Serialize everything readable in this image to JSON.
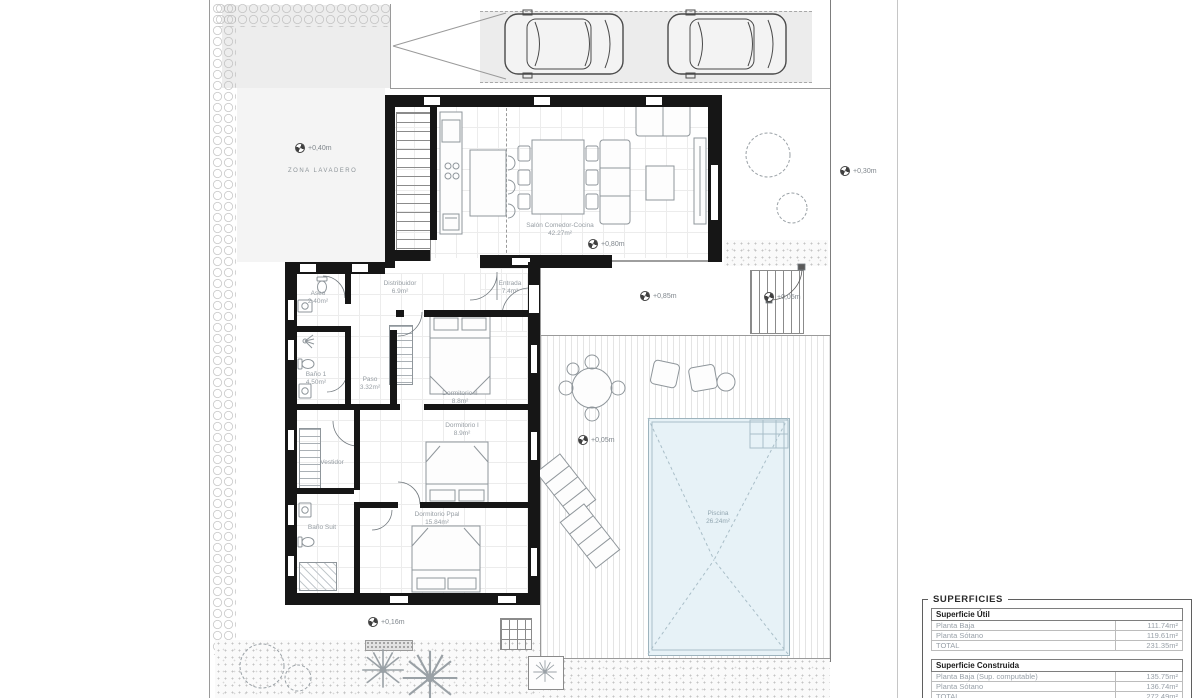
{
  "site": {
    "zona_lavadero": "ZONA LAVADERO",
    "levels": {
      "patio": "+0,40m",
      "salon": "+0,80m",
      "terraza": "+0,85m",
      "gate": "+0,05m",
      "deck": "+0,05m",
      "jardin": "+0,16m",
      "lateral": "+0,30m"
    }
  },
  "rooms": {
    "salon": {
      "name": "Salón Comedor-Cocina",
      "area": "42.27m²"
    },
    "distribuidor": {
      "name": "Distribuidor",
      "area": "6.9m²"
    },
    "entrada": {
      "name": "Entrada",
      "area": "7.4m²"
    },
    "aseo": {
      "name": "Aseo",
      "area": "2.40m²"
    },
    "bano1": {
      "name": "Baño 1",
      "area": "4.50m²"
    },
    "paso": {
      "name": "Paso",
      "area": "3.32m²"
    },
    "dorm2": {
      "name": "Dormitorio II",
      "area": "8.8m²"
    },
    "dorm1": {
      "name": "Dormitorio I",
      "area": "8.9m²"
    },
    "vestidor": {
      "name": "Vestidor"
    },
    "banosuit": {
      "name": "Baño Suit"
    },
    "dormppal": {
      "name": "Dormitorio Ppal",
      "area": "15.84m²"
    },
    "piscina": {
      "name": "Piscina",
      "area": "26.24m²"
    }
  },
  "summary": {
    "box_title": "SUPERFICIES",
    "util": {
      "title": "Superficie Útil",
      "rows": [
        {
          "label": "Planta Baja",
          "value": "111.74m²"
        },
        {
          "label": "Planta Sótano",
          "value": "119.61m²"
        },
        {
          "label": "TOTAL",
          "value": "231.35m²"
        }
      ]
    },
    "construida": {
      "title": "Superficie Construida",
      "rows": [
        {
          "label": "Planta Baja (Sup. computable)",
          "value": "135.75m²"
        },
        {
          "label": "Planta Sótano",
          "value": "136.74m²"
        },
        {
          "label": "TOTAL",
          "value": "272.49m²"
        }
      ]
    }
  },
  "colors": {
    "pool_water": "#e7f2f7",
    "paving": "#ededed",
    "wall": "#161616",
    "label_text": "#969da3"
  }
}
